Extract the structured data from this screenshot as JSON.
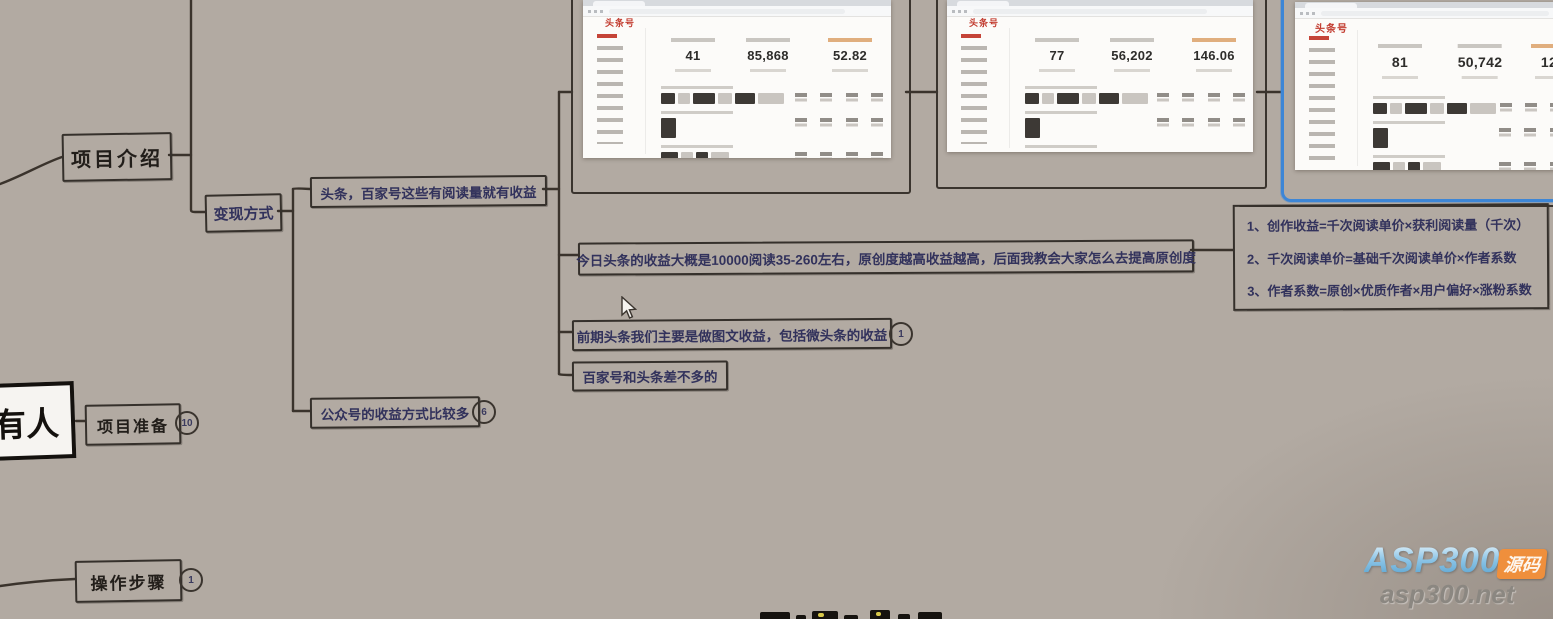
{
  "canvas": {
    "bg": "#b2aaa2",
    "selection_blue": "#3d86d6",
    "logo_red": "#c23b2f",
    "node_text_navy": "#32325c",
    "watermark_orange": "#ef8f3c"
  },
  "mindmap": {
    "root_partial": {
      "label": "有人"
    },
    "nodes": {
      "project_intro": {
        "label": "项目介绍"
      },
      "monetization": {
        "label": "变现方式"
      },
      "toutiao_baijia": {
        "label": "头条，百家号这些有阅读量就有收益"
      },
      "income_detail": {
        "label": "今日头条的收益大概是10000阅读35-260左右，原创度越高收益越高，后面我教会大家怎么去提高原创度"
      },
      "early_stage": {
        "label": "前期头条我们主要是做图文收益，包括微头条的收益",
        "badge": "1"
      },
      "baijia_similar": {
        "label": "百家号和头条差不多的"
      },
      "gongzhonghao": {
        "label": "公众号的收益方式比较多",
        "badge": "6"
      },
      "project_prep": {
        "label": "项目准备",
        "badge": "10"
      },
      "steps": {
        "label": "操作步骤",
        "badge": "1"
      }
    },
    "formula_box": {
      "lines": [
        "1、创作收益=千次阅读单价×获利阅读量（千次）",
        "2、千次阅读单价=基础千次阅读单价×作者系数",
        "3、作者系数=原创×优质作者×用户偏好×涨粉系数"
      ]
    }
  },
  "screenshots": [
    {
      "logo": "头条号",
      "stats": [
        {
          "value": "41"
        },
        {
          "value": "85,868"
        },
        {
          "value": "52.82"
        }
      ]
    },
    {
      "logo": "头条号",
      "stats": [
        {
          "value": "77"
        },
        {
          "value": "56,202"
        },
        {
          "value": "146.06"
        }
      ]
    },
    {
      "logo": "头条号",
      "stats": [
        {
          "value": "81"
        },
        {
          "value": "50,742"
        },
        {
          "value": "120"
        }
      ],
      "selected": true
    }
  ],
  "watermark": {
    "brand": "ASP300",
    "tag": "源码",
    "url": "asp300.net"
  }
}
